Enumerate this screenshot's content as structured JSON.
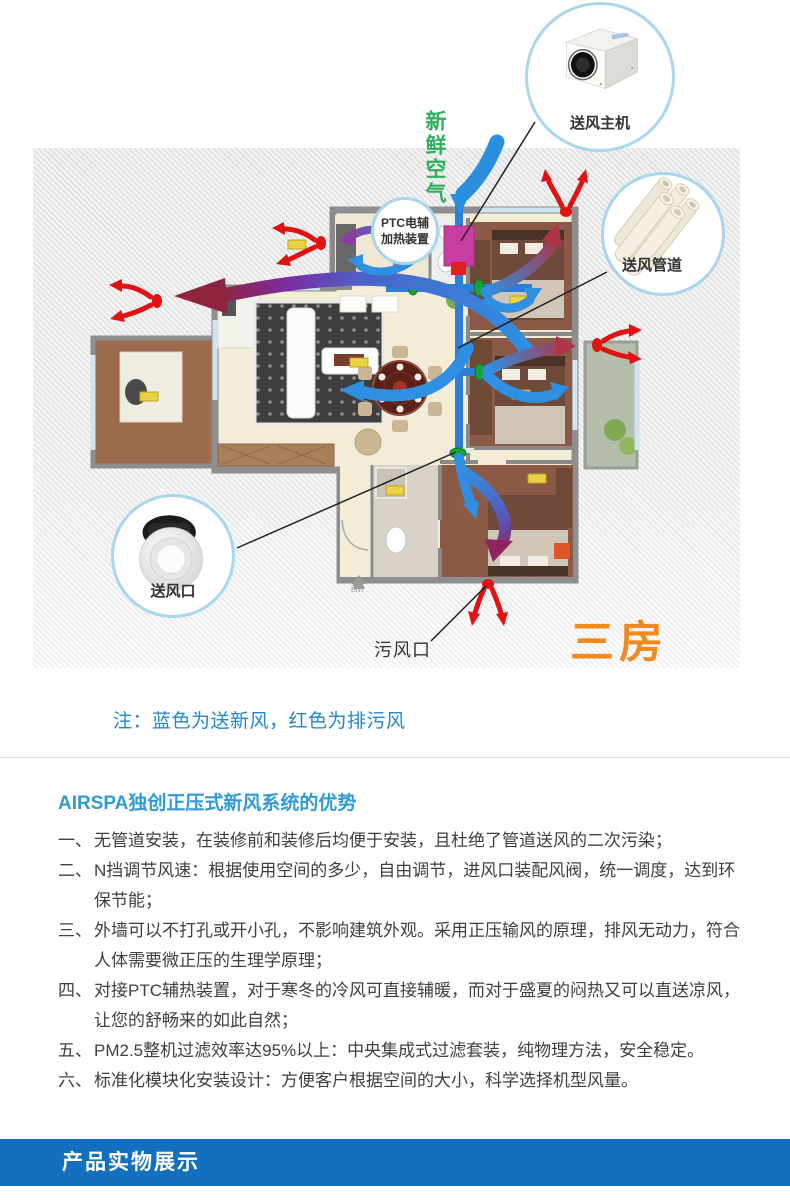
{
  "diagram": {
    "fresh_air_label": "新鲜空气",
    "ptc": {
      "line1": "PTC电辅",
      "line2": "加热装置"
    },
    "callouts": {
      "main_unit": {
        "label": "送风主机"
      },
      "duct": {
        "label": "送风管道"
      },
      "outlet": {
        "label": "送风口"
      }
    },
    "dirty_outlet_label": "污风口",
    "rooms_logo": "三房",
    "ent_label": "ENT",
    "note": "注：蓝色为送新风，红色为排污风",
    "colors": {
      "supply_blue": "#2f8fe2",
      "exhaust_red": "#e01212",
      "fresh_green": "#2fae5e",
      "logo_orange": "#f2891d",
      "ptc_pink": "#c73da1",
      "callout_border": "#a8d6ef"
    }
  },
  "advantages": {
    "heading": "AIRSPA独创正压式新风系统的优势",
    "items": [
      {
        "num": "一、",
        "text": "无管道安装，在装修前和装修后均便于安装，且杜绝了管道送风的二次污染；"
      },
      {
        "num": "二、",
        "text": "N挡调节风速：根据使用空间的多少，自由调节，进风口装配风阀，统一调度，达到环保节能；"
      },
      {
        "num": "三、",
        "text": "外墙可以不打孔或开小孔，不影响建筑外观。采用正压输风的原理，排风无动力，符合人体需要微正压的生理学原理；"
      },
      {
        "num": "四、",
        "text": "对接PTC辅热装置，对于寒冬的冷风可直接辅暖，而对于盛夏的闷热又可以直送凉风，让您的舒畅来的如此自然；"
      },
      {
        "num": "五、",
        "text": "PM2.5整机过滤效率达95%以上：中央集成式过滤套装，纯物理方法，安全稳定。"
      },
      {
        "num": "六、",
        "text": "标准化模块化安装设计：方便客户根据空间的大小，科学选择机型风量。"
      }
    ]
  },
  "banner": {
    "title": "产品实物展示"
  }
}
